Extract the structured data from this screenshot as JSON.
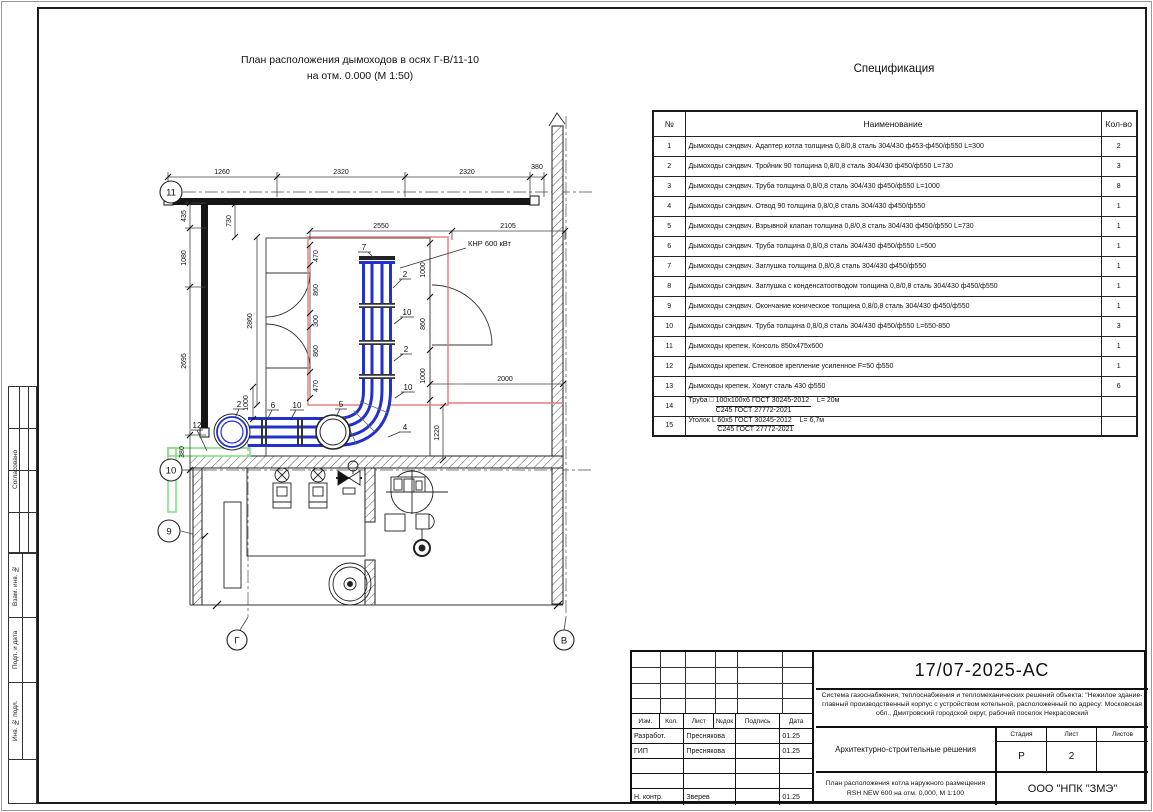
{
  "sheet": {
    "stamps": [
      "Согласовано",
      "Взам. инв. №",
      "Подп. и дата",
      "Инв. № подл."
    ]
  },
  "plan": {
    "title1": "План расположения дымоходов в осях Г-В/11-10",
    "title2": "на отм. 0.000 (М 1:50)",
    "axes": {
      "a11": "11",
      "a10": "10",
      "a9": "9",
      "ag": "Г",
      "av": "В"
    },
    "labels": {
      "boiler": "КНР 600 кВт"
    },
    "dims": {
      "top": [
        "1260",
        "2320",
        "2320",
        "380"
      ],
      "left": [
        "435",
        "1080",
        "2695",
        "380"
      ],
      "inner_top": [
        "2550",
        "2105"
      ],
      "inner_left": [
        "470",
        "860",
        "300",
        "860",
        "470"
      ],
      "inner_right": [
        "1000",
        "860",
        "1000"
      ],
      "d730": "730",
      "d2860": "2860",
      "d2000": "2000",
      "d1220": "1220",
      "d1000": "1000"
    },
    "callouts": {
      "pipe_vertical": [
        "7",
        "2",
        "10",
        "2",
        "10"
      ],
      "pipe_horizontal": [
        "2",
        "6",
        "10",
        "5",
        "4"
      ],
      "console": "12"
    }
  },
  "specification": {
    "title": "Спецификация",
    "columns": [
      "№",
      "Наименование",
      "Кол-во"
    ],
    "rows": [
      {
        "num": "1",
        "name": "Дымоходы сэндвич. Адаптер котла толщина 0,8/0,8 сталь 304/430 ф453-ф450/ф550 L=300",
        "qty": "2"
      },
      {
        "num": "2",
        "name": "Дымоходы сэндвич. Тройник 90 толщина 0,8/0,8 сталь 304/430 ф450/ф550 L=730",
        "qty": "3"
      },
      {
        "num": "3",
        "name": "Дымоходы сэндвич. Труба толщина 0,8/0,8 сталь 304/430 ф450/ф550 L=1000",
        "qty": "8"
      },
      {
        "num": "4",
        "name": "Дымоходы сэндвич. Отвод 90 толщина 0,8/0,8 сталь 304/430 ф450/ф550",
        "qty": "1"
      },
      {
        "num": "5",
        "name": "Дымоходы сэндвич. Взрывной клапан толщина 0,8/0,8 сталь 304/430 ф450/ф550 L=730",
        "qty": "1"
      },
      {
        "num": "6",
        "name": "Дымоходы сэндвич. Труба толщина 0,8/0,8 сталь 304/430 ф450/ф550 L=500",
        "qty": "1"
      },
      {
        "num": "7",
        "name": "Дымоходы сэндвич. Заглушка толщина 0,8/0,8 сталь 304/430 ф450/ф550",
        "qty": "1"
      },
      {
        "num": "8",
        "name": "Дымоходы сэндвич. Заглушка с конденсатоотводом толщина 0,8/0,8 сталь 304/430 ф450/ф550",
        "qty": "1"
      },
      {
        "num": "9",
        "name": "Дымоходы сэндвич. Окончание коническое толщина 0,8/0,8 сталь 304/430 ф450/ф550",
        "qty": "1"
      },
      {
        "num": "10",
        "name": "Дымоходы сэндвич. Труба толщина 0,8/0,8 сталь 304/430 ф450/ф550 L=650-850",
        "qty": "3"
      },
      {
        "num": "11",
        "name": "Дымоходы крепеж. Консоль 850х475х600",
        "qty": "1"
      },
      {
        "num": "12",
        "name": "Дымоходы крепеж. Стеновое крепление усиленное F=50 ф550",
        "qty": "1"
      },
      {
        "num": "13",
        "name": "Дымоходы крепеж. Хомут сталь 430 ф550",
        "qty": "6"
      },
      {
        "num": "14",
        "prefix": "Труба □",
        "frac_top": "100х100х6 ГОСТ 30245-2012",
        "frac_bottom": "С245 ГОСТ 27772-2021",
        "suffix": "L= 20м",
        "qty": ""
      },
      {
        "num": "15",
        "prefix": "Уголок L",
        "frac_top": "60х5 ГОСТ 30245-2012",
        "frac_bottom": "С245 ГОСТ 27772-2021",
        "suffix": "L= 6,7м",
        "qty": ""
      }
    ]
  },
  "title_block": {
    "doc_number": "17/07-2025-АС",
    "description": "Система газоснабжения, теплоснабжения и тепломеханических решений объекта: \"Нежилое здание-главный производственный корпус с устройством котельной, расположенный по адресу: Московская обл., Дмитровский городской округ, рабочий поселок Некрасовский",
    "section_title": "Архитектурно-строительные решения",
    "sheet_title": "План расположения котла наружного размещения RSH NEW 600 на отм. 0,000,  М 1:100",
    "company": "ООО \"НПК \"ЗМЭ\"",
    "cols": [
      "Изм.",
      "Кол.",
      "Лист",
      "№док",
      "Подпись",
      "Дата"
    ],
    "stage_header": [
      "Стадия",
      "Лист",
      "Листов"
    ],
    "stage_values": [
      "Р",
      "2",
      ""
    ],
    "sig_rows": [
      {
        "role": "Разработ.",
        "name": "Преснякова",
        "sign": "",
        "date": "01.25"
      },
      {
        "role": "ГИП",
        "name": "Преснякова",
        "sign": "",
        "date": "01.25"
      },
      {
        "role": "",
        "name": "",
        "sign": "",
        "date": ""
      },
      {
        "role": "",
        "name": "",
        "sign": "",
        "date": ""
      },
      {
        "role": "Н. контр.",
        "name": "Зверев",
        "sign": "",
        "date": "01.25"
      }
    ]
  }
}
